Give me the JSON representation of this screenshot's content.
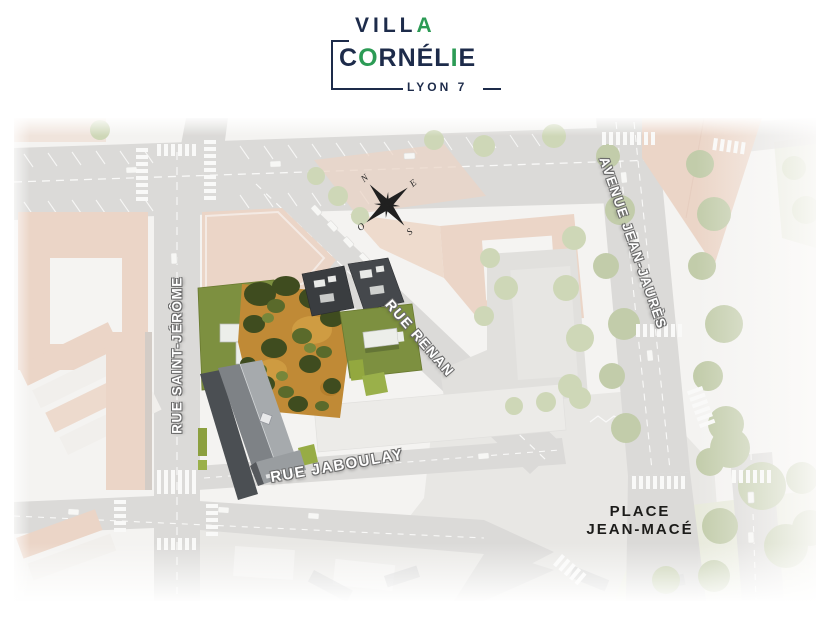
{
  "logo": {
    "villa_prefix": "VILL",
    "villa_suffix": "A",
    "cornelie_c": "C",
    "cornelie_o": "O",
    "cornelie_rnel": "RNÉL",
    "cornelie_i": "I",
    "cornelie_e": "E",
    "subtitle": "LYON 7",
    "colors": {
      "navy": "#1d2b4a",
      "green": "#2c9b55"
    }
  },
  "map": {
    "street_labels": {
      "rue_saint_jerome": "RUE SAINT-JÉRÔME",
      "rue_renan": "RUE RENAN",
      "avenue_jean_jaures": "AVENUE JEAN-JAURÈS",
      "rue_jaboulay": "RUE JABOULAY"
    },
    "place_label": {
      "line1": "PLACE",
      "line2": "JEAN-MACÉ"
    },
    "compass": {
      "north": "N",
      "east": "E",
      "south": "S",
      "west": "O"
    },
    "site_colors": {
      "green_roof": "#7d9040",
      "garden_orange": "#c08a36",
      "new_building_gray": "#a6aaad",
      "tree_dark": "#3f4c1f"
    }
  }
}
